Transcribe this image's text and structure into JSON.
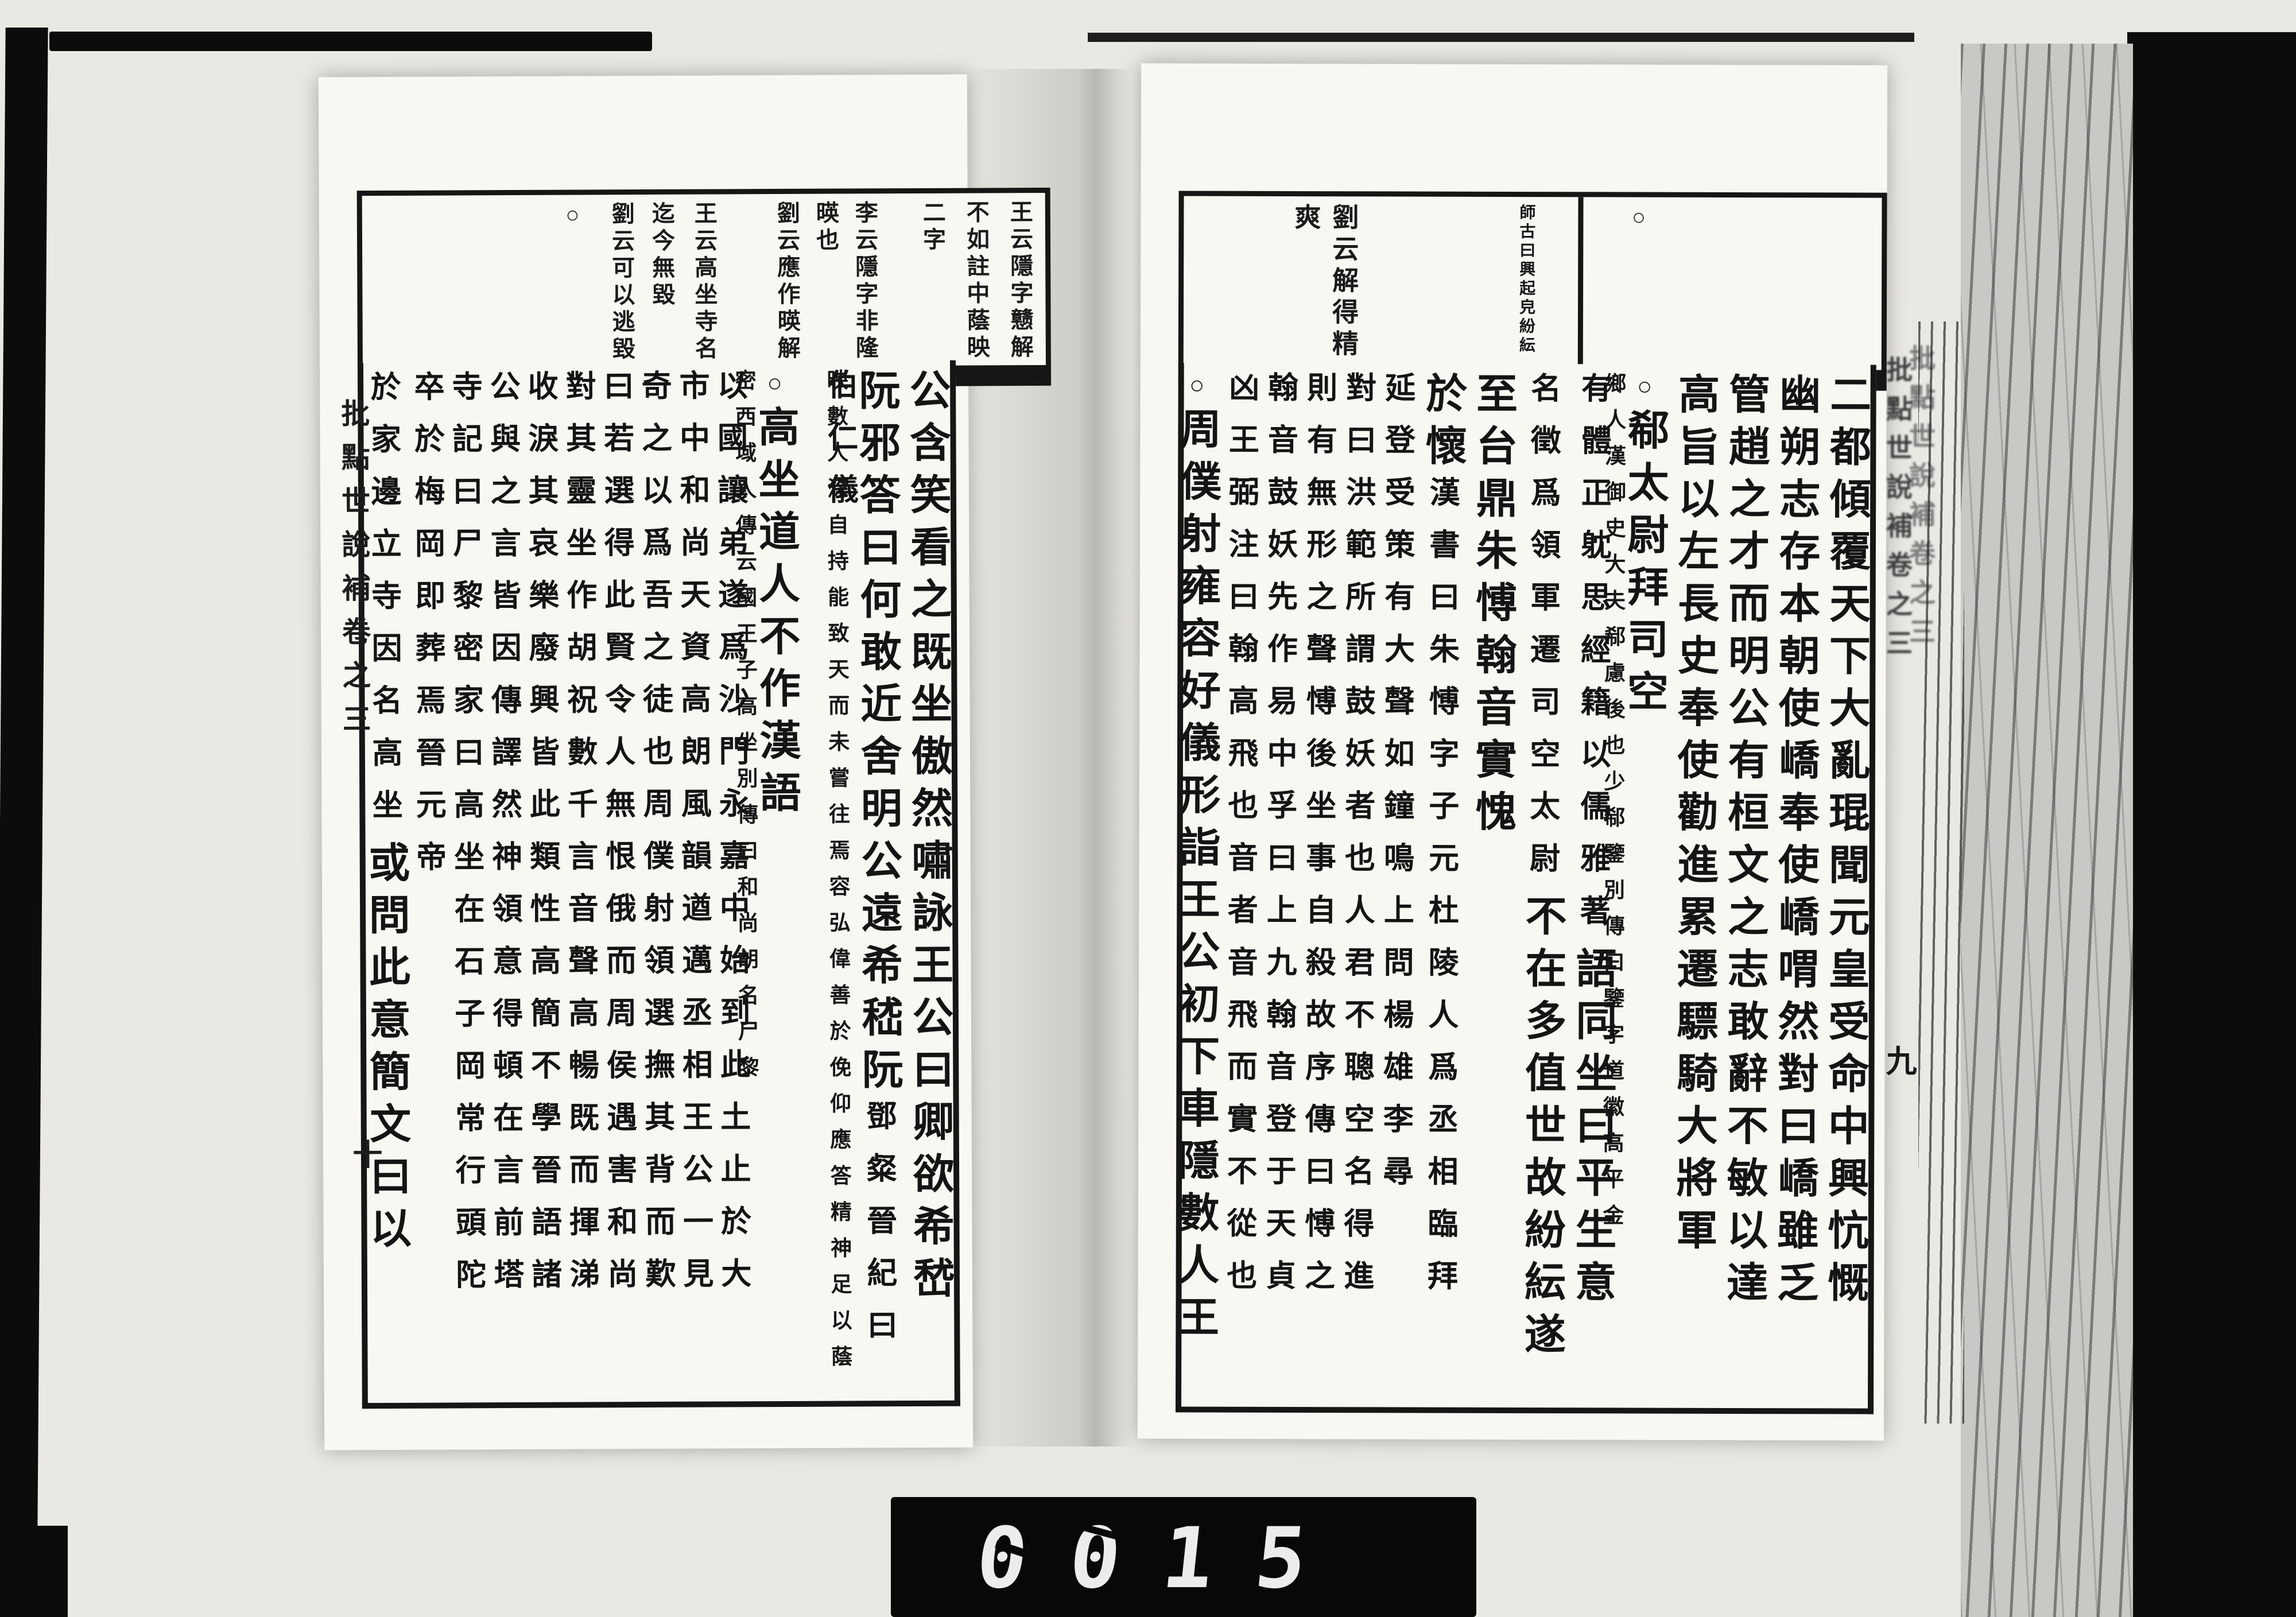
{
  "counter": {
    "digits": "0015"
  },
  "spine": {
    "left_title": "批點世說補卷之三",
    "left_leaf": "十",
    "right_title": "批點世說補卷之三",
    "right_leaf": "九"
  },
  "pages": {
    "right": {
      "annotations": [
        {
          "kind": "ring",
          "t": "○",
          "ro": 400
        },
        {
          "kind": "pair",
          "a": "紛紜",
          "b": "師古曰興起皃",
          "ro": 600
        },
        {
          "kind": "line-big",
          "t": "劉云解得精爽",
          "ro": 905
        }
      ],
      "band_dividers": [
        520
      ],
      "columns": [
        {
          "w": 88,
          "segs": [
            {
              "s": "big",
              "t": "二都傾覆天下大亂琨聞元皇受命中興忼慨"
            }
          ]
        },
        {
          "w": 88,
          "segs": [
            {
              "s": "big",
              "t": "幽朔志存本朝使嶠奉使嶠喟然對曰嶠雖乏"
            }
          ]
        },
        {
          "w": 88,
          "segs": [
            {
              "s": "big",
              "t": "管趙之才而明公有桓文之志敢辭不敏以達"
            }
          ]
        },
        {
          "w": 88,
          "segs": [
            {
              "s": "big",
              "t": "高旨以左長史奉使勸進累遷驃騎大將軍"
            }
          ]
        },
        {
          "w": 88,
          "segs": [
            {
              "s": "ring",
              "t": "○"
            },
            {
              "s": "big",
              "t": "郗太尉拜司空"
            },
            {
              "s": "pair",
              "a": "郗鑒別傳曰鑒字道徽高平金",
              "b": "鄉人漢御史大夫郗慮後也少"
            }
          ]
        },
        {
          "w": 88,
          "segs": [
            {
              "s": "note",
              "t": "有體正躭思經籍以儒雅著"
            },
            {
              "s": "big",
              "t": "語同坐曰平生意"
            }
          ]
        },
        {
          "w": 88,
          "segs": [
            {
              "s": "note",
              "t": "名徵爲領軍遷司空太尉"
            },
            {
              "s": "big",
              "t": "不在多值世故紛紜遂"
            }
          ]
        },
        {
          "w": 88,
          "segs": [
            {
              "s": "big",
              "t": "至台鼎朱愽翰音實愧"
            }
          ]
        },
        {
          "w": 88,
          "segs": [
            {
              "s": "big",
              "t": "於懷"
            },
            {
              "s": "note",
              "t": "漢書曰朱愽字子元杜陵人爲丞相臨拜"
            }
          ]
        },
        {
          "w": 68,
          "segs": [
            {
              "s": "note",
              "t": "延登受策有大聲如鐘鳴上問楊雄李尋"
            }
          ]
        },
        {
          "w": 68,
          "segs": [
            {
              "s": "note",
              "t": "對曰洪範所謂鼓妖者也人君不聰空名得進"
            }
          ]
        },
        {
          "w": 68,
          "segs": [
            {
              "s": "note",
              "t": "則有無形之聲愽後坐事自殺故序傳曰愽之"
            }
          ]
        },
        {
          "w": 68,
          "segs": [
            {
              "s": "note",
              "t": "翰音鼓妖先作易中孚曰上九翰音登于天貞"
            }
          ]
        },
        {
          "w": 68,
          "segs": [
            {
              "s": "note",
              "t": "凶王弼注曰翰高飛也音者音飛而實不從也"
            }
          ]
        },
        {
          "w": 90,
          "segs": [
            {
              "s": "ring",
              "t": "○"
            },
            {
              "s": "big",
              "t": "周僕射雍容好儀形詣王公初下車隱數人王"
            }
          ]
        }
      ]
    },
    "left": {
      "annotations": [
        {
          "kind": "line",
          "t": "王云隱字戆解",
          "ro": 16
        },
        {
          "kind": "line",
          "t": "不如註中蔭映",
          "ro": 92
        },
        {
          "kind": "line",
          "t": "二字",
          "ro": 168
        },
        {
          "kind": "line",
          "t": "李云隱字非隆",
          "ro": 286
        },
        {
          "kind": "line",
          "t": "暎也",
          "ro": 354
        },
        {
          "kind": "line",
          "t": "劉云應作暎解",
          "ro": 422
        },
        {
          "kind": "line",
          "t": "王云高坐寺名",
          "ro": 566
        },
        {
          "kind": "line",
          "t": "迄今無毀",
          "ro": 640
        },
        {
          "kind": "line",
          "t": "劉云可以逃毀",
          "ro": 710
        },
        {
          "kind": "ring",
          "t": "○",
          "ro": 800
        }
      ],
      "band_dividers": [],
      "columns": [
        {
          "w": 88,
          "segs": [
            {
              "s": "big",
              "t": "公含笑看之既坐傲然嘯詠王公曰卿欲希嵆"
            }
          ]
        },
        {
          "w": 88,
          "segs": [
            {
              "s": "big",
              "t": "阮邪答曰何敢近舍明公遠希嵇阮"
            },
            {
              "s": "note",
              "t": "鄧粲晉紀曰伯仁儀"
            }
          ]
        },
        {
          "w": 88,
          "segs": [
            {
              "s": "pair",
              "a": "容弘偉善於俛仰應答精神足以蔭",
              "b": "映數人深自持能致天而未嘗往焉"
            }
          ]
        },
        {
          "w": 88,
          "segs": [
            {
              "s": "ring",
              "t": "○"
            },
            {
              "s": "big",
              "t": "高坐道人不作漢語"
            },
            {
              "s": "pair",
              "a": "高坐別傳曰和尚胡名尸黎",
              "b": "密西域人傳云國王子"
            }
          ]
        },
        {
          "w": 66,
          "segs": [
            {
              "s": "note",
              "t": "以國讓弟遂爲沙門永嘉中始到此土止於大"
            }
          ]
        },
        {
          "w": 66,
          "segs": [
            {
              "s": "note",
              "t": "市中和尚天資高朗風韻遒邁丞相王公一見"
            }
          ]
        },
        {
          "w": 66,
          "segs": [
            {
              "s": "note",
              "t": "奇之以爲吾之徒也周僕射領選撫其背而歎"
            }
          ]
        },
        {
          "w": 66,
          "segs": [
            {
              "s": "note",
              "t": "曰若選得此賢令人無恨俄而周侯遇害和尚"
            }
          ]
        },
        {
          "w": 66,
          "segs": [
            {
              "s": "note",
              "t": "對其靈坐作胡祝數千言音聲高暢既而揮涕"
            }
          ]
        },
        {
          "w": 66,
          "segs": [
            {
              "s": "note",
              "t": "收淚其哀樂廢興皆此類性高簡不學晉語諸"
            }
          ]
        },
        {
          "w": 66,
          "segs": [
            {
              "s": "note",
              "t": "公與之言皆因傳譯然神領意得頓在言前塔"
            }
          ]
        },
        {
          "w": 66,
          "segs": [
            {
              "s": "note",
              "t": "寺記曰尸黎密家曰高坐在石子岡常行頭陀"
            }
          ]
        },
        {
          "w": 66,
          "segs": [
            {
              "s": "note",
              "t": "卒於梅岡即葬焉晉元帝"
            }
          ]
        },
        {
          "w": 96,
          "segs": [
            {
              "s": "note",
              "t": "於家邊立寺因名高坐"
            },
            {
              "s": "big",
              "t": "或問此意簡文曰以"
            }
          ]
        }
      ]
    }
  }
}
